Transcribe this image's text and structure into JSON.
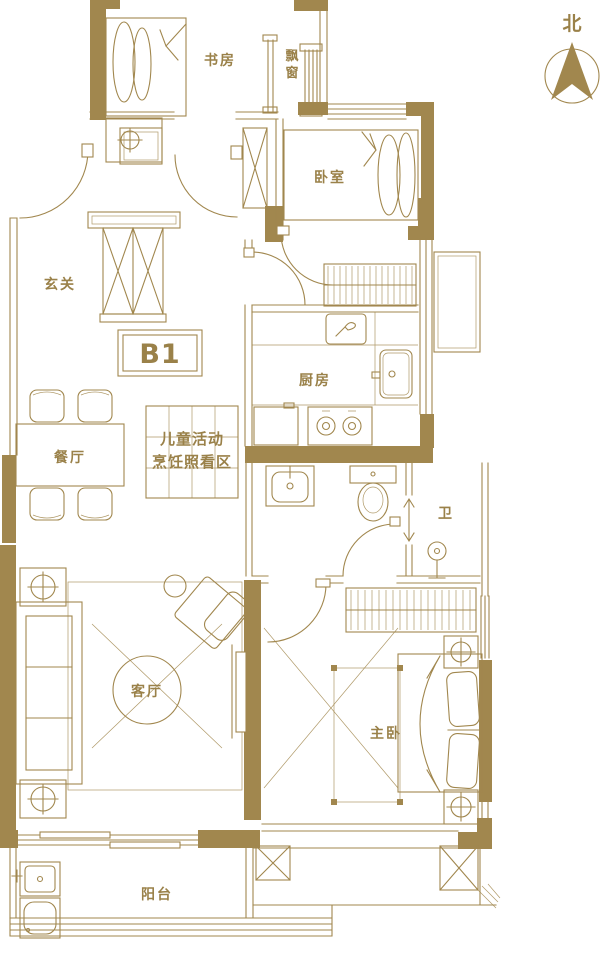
{
  "plan": {
    "unit_label": "B1",
    "compass": {
      "label": "北"
    },
    "rooms": {
      "foyer": "玄关",
      "study": "书房",
      "bay_window_chars": [
        "飘",
        "窗"
      ],
      "bedroom": "卧室",
      "kitchen": "厨房",
      "dining": "餐厅",
      "bathroom": "卫",
      "living": "客厅",
      "master": "主卧",
      "balcony": "阳台",
      "children_zone_line1": "儿童活动",
      "children_zone_line2": "烹饪照看区"
    },
    "colors": {
      "wall": "#A1874E",
      "text": "#9A8149",
      "background": "#FFFFFF"
    }
  }
}
